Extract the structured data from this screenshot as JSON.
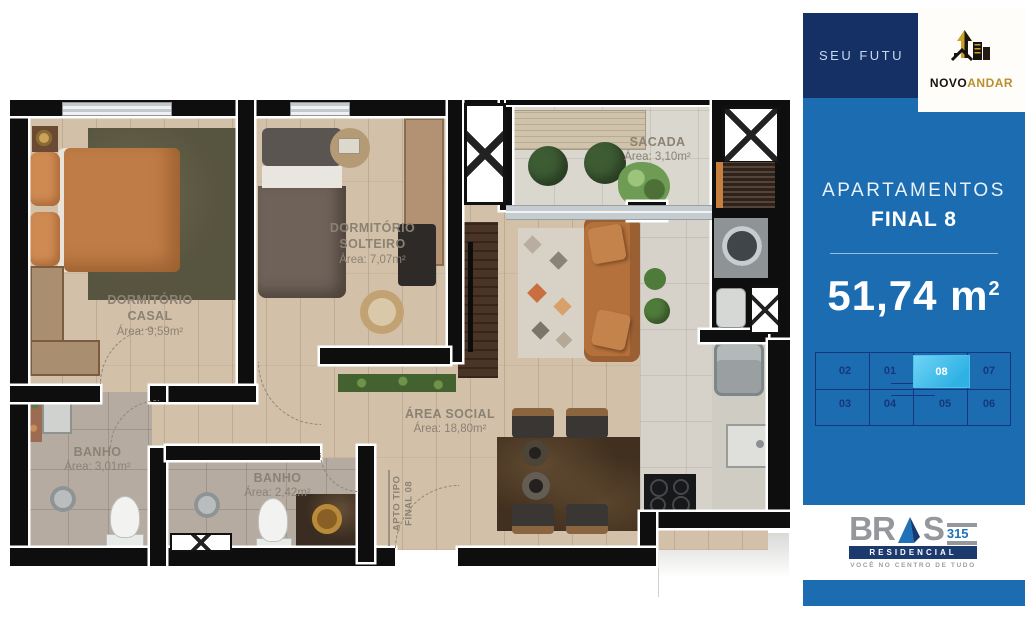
{
  "sidebar": {
    "banner": {
      "text": "SEU FUTU"
    },
    "novoandar": {
      "dark": "NOVO",
      "gold": "ANDAR"
    },
    "panel": {
      "title": "APARTAMENTOS",
      "subtitle": "FINAL 8",
      "area": "51,74 m",
      "area_exp": "2"
    },
    "floorplate": {
      "units_top": [
        "02",
        "01",
        "08",
        "07"
      ],
      "units_bottom": [
        "03",
        "04",
        "05",
        "06"
      ],
      "selected_unit": "08"
    },
    "brand": {
      "left": "BR",
      "right": "S",
      "number": "315",
      "line": "RESIDENCIAL",
      "tagline": "VOCÊ NO CENTRO DE TUDO"
    }
  },
  "plan": {
    "rooms": {
      "casal": {
        "line1": "DORMITÓRIO",
        "line2": "CASAL",
        "area": "Área: 9,59m²"
      },
      "solteiro": {
        "line1": "DORMITÓRIO",
        "line2": "SOLTEIRO",
        "area": "Área: 7,07m²"
      },
      "sacada": {
        "line1": "SACADA",
        "area": "Área: 3,10m²"
      },
      "social": {
        "line1": "ÁREA SOCIAL",
        "area": "Área: 18,80m²"
      },
      "banho1": {
        "line1": "BANHO",
        "area": "Área: 3,01m²"
      },
      "banho2": {
        "line1": "BANHO",
        "area": "Área: 2,42m²"
      },
      "apto": {
        "line1": "APTO TIPO",
        "line2": "FINAL 08"
      }
    }
  },
  "colors": {
    "panel_blue": "#1c6cb1",
    "navy": "#143064",
    "highlight_cyan": "#3fc0ee",
    "unit_navy": "#16377d",
    "logo_gold": "#c9a22d",
    "label_gray": "#8b8274"
  }
}
